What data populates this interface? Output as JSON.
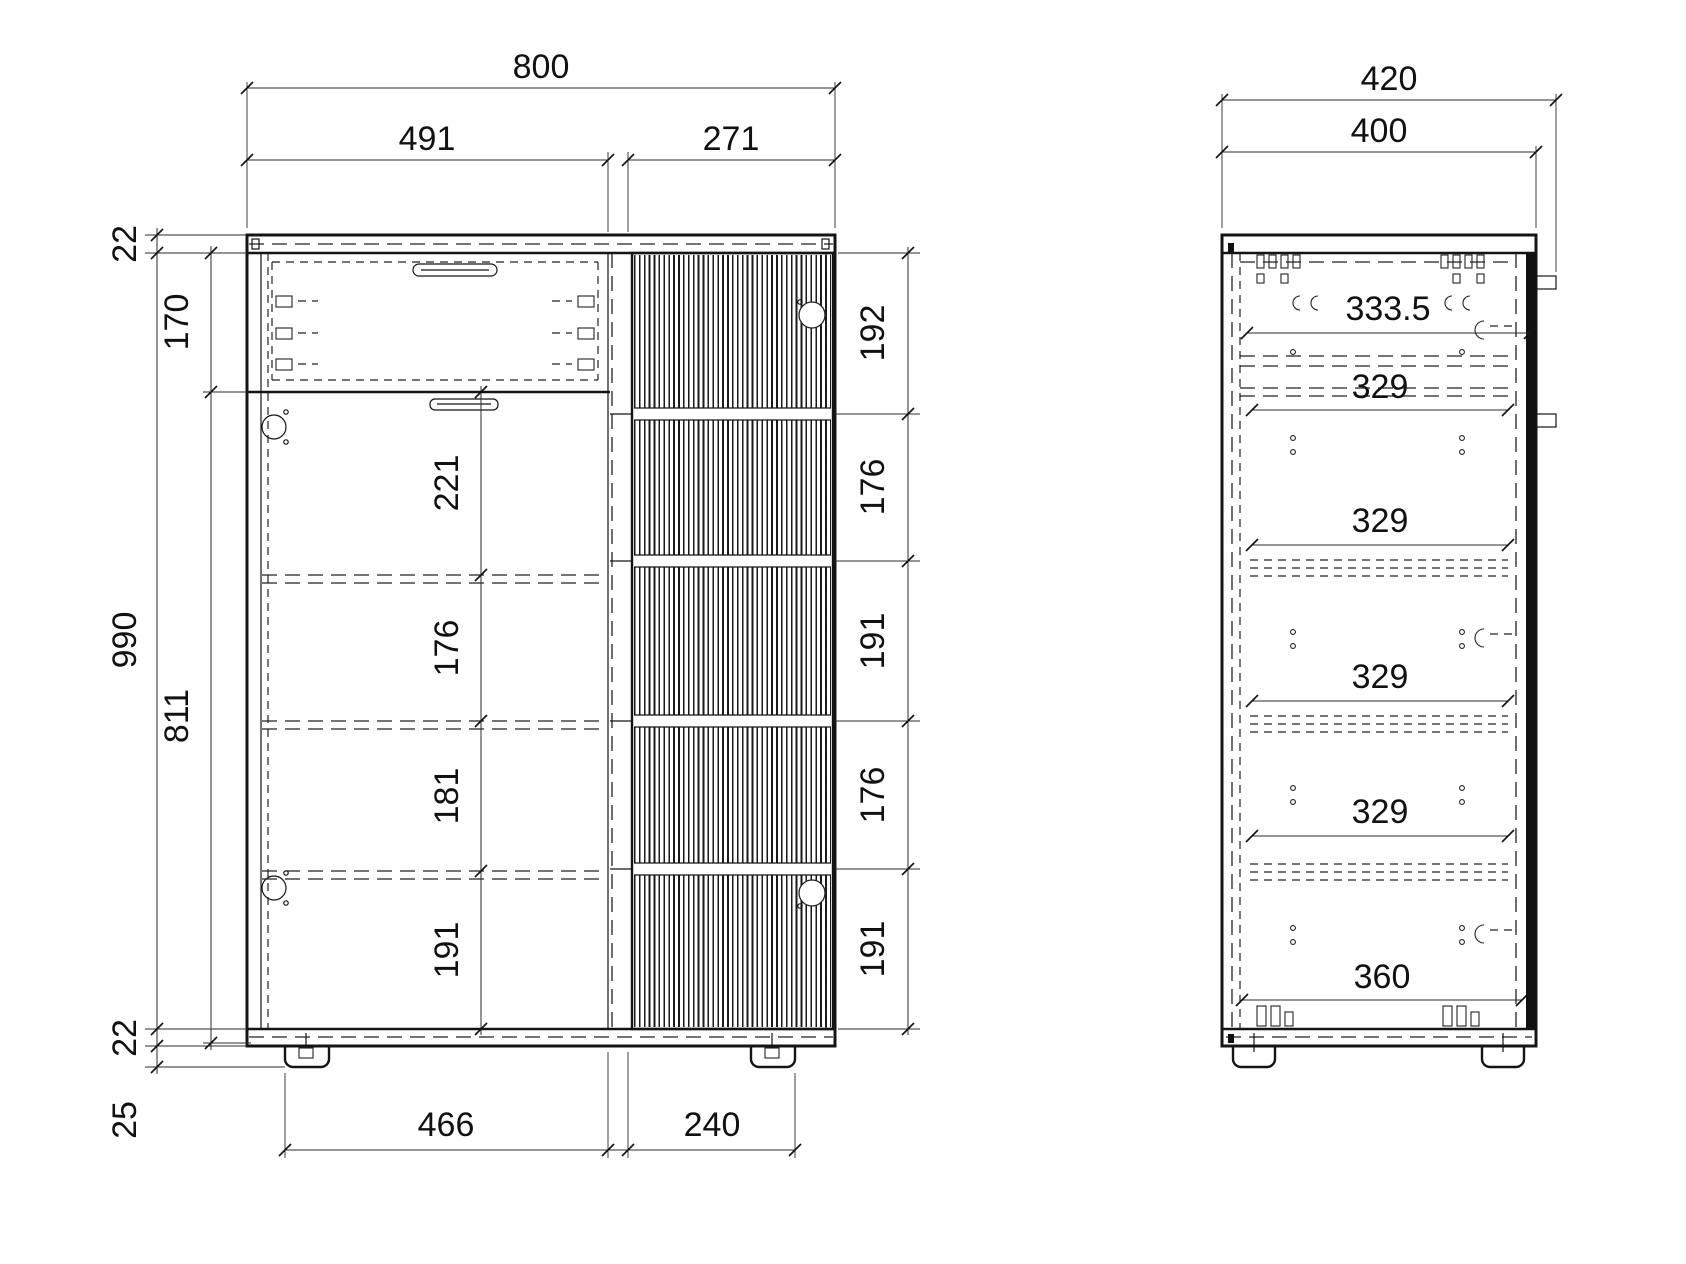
{
  "front_view": {
    "top_dims": {
      "overall": "800",
      "left_section": "491",
      "right_section": "271"
    },
    "left_dims": {
      "top_panel": "22",
      "drawer_front": "170",
      "overall_height": "990",
      "door_front": "811",
      "bottom_panel": "22",
      "feet": "25"
    },
    "center_shelf_dims": [
      "221",
      "176",
      "181",
      "191"
    ],
    "right_shelf_dims": [
      "192",
      "176",
      "191",
      "176",
      "191"
    ],
    "bottom_dims": {
      "left_span": "466",
      "right_span": "240"
    }
  },
  "side_view": {
    "top_dims": {
      "overall_depth": "420",
      "body_depth": "400"
    },
    "depth_dims": [
      "333.5",
      "329",
      "329",
      "329",
      "329",
      "360"
    ]
  },
  "style": {
    "line_color": "#141414",
    "dim_color": "#2b2b2b",
    "background": "#ffffff"
  }
}
